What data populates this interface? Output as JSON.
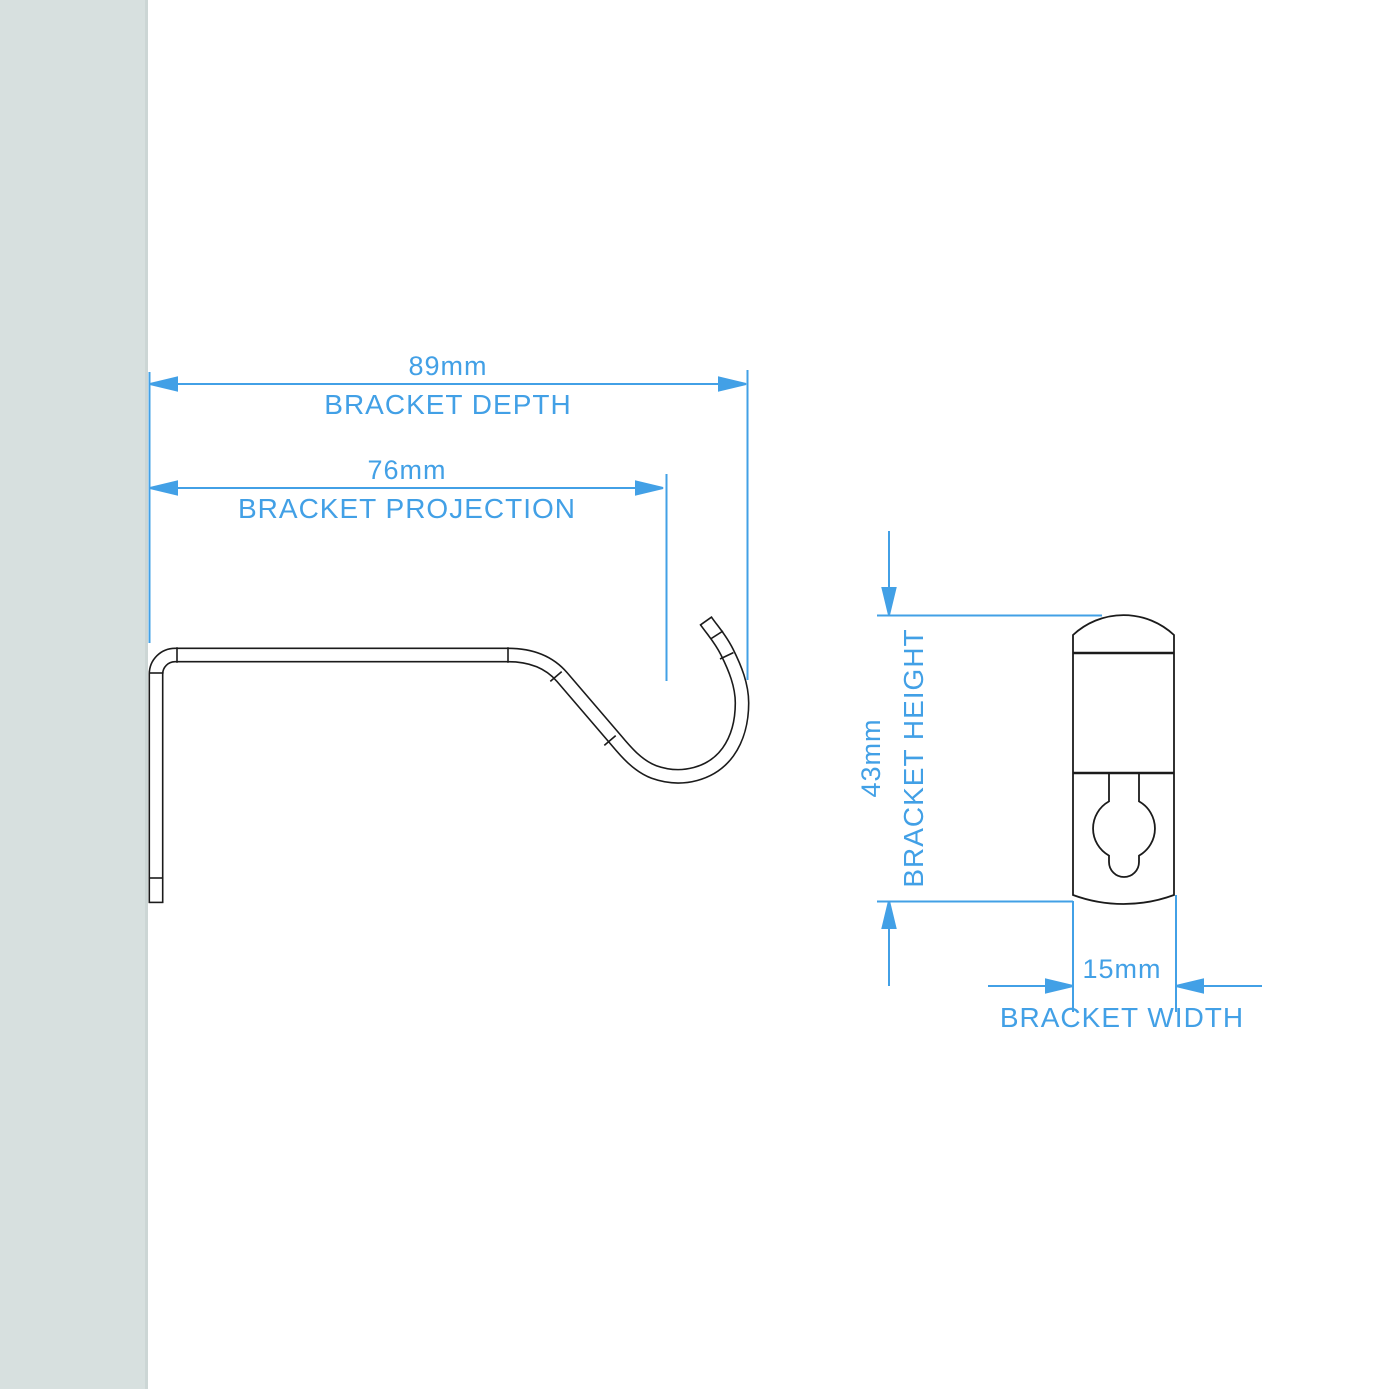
{
  "drawing": {
    "title": "curtain-pole-bracket-dimension-diagram",
    "accent_color": "#42a0e6",
    "line_color": "#1b1b1b",
    "wall_color": "#d7e0df"
  },
  "dimensions": {
    "depth": {
      "value": "89mm",
      "label": "BRACKET DEPTH"
    },
    "projection": {
      "value": "76mm",
      "label": "BRACKET PROJECTION"
    },
    "height": {
      "value": "43mm",
      "label": "BRACKET HEIGHT"
    },
    "width": {
      "value": "15mm",
      "label": "BRACKET WIDTH"
    }
  }
}
